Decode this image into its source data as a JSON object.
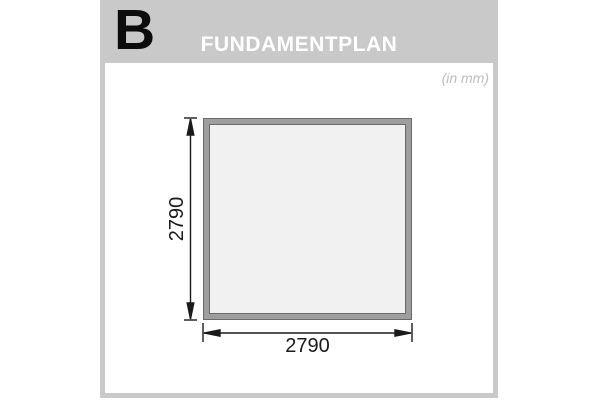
{
  "header": {
    "section_letter": "B",
    "title": "FUNDAMENTPLAN"
  },
  "panel": {
    "units_note": "(in mm)"
  },
  "drawing": {
    "type": "foundation-plan",
    "shape": "square",
    "width_mm": 2790,
    "height_mm": 2790,
    "width_label": "2790",
    "height_label": "2790"
  },
  "colors": {
    "card_gray": "#c9c9c9",
    "title_text": "#ffffff",
    "section_letter": "#0c0c0c",
    "units_text": "#bdbdbd",
    "frame_fill": "#9e9e9e",
    "frame_outline": "#6a6a6a",
    "frame_interior": "#f1f1f1",
    "dimension_ink": "#1a1a1a"
  }
}
